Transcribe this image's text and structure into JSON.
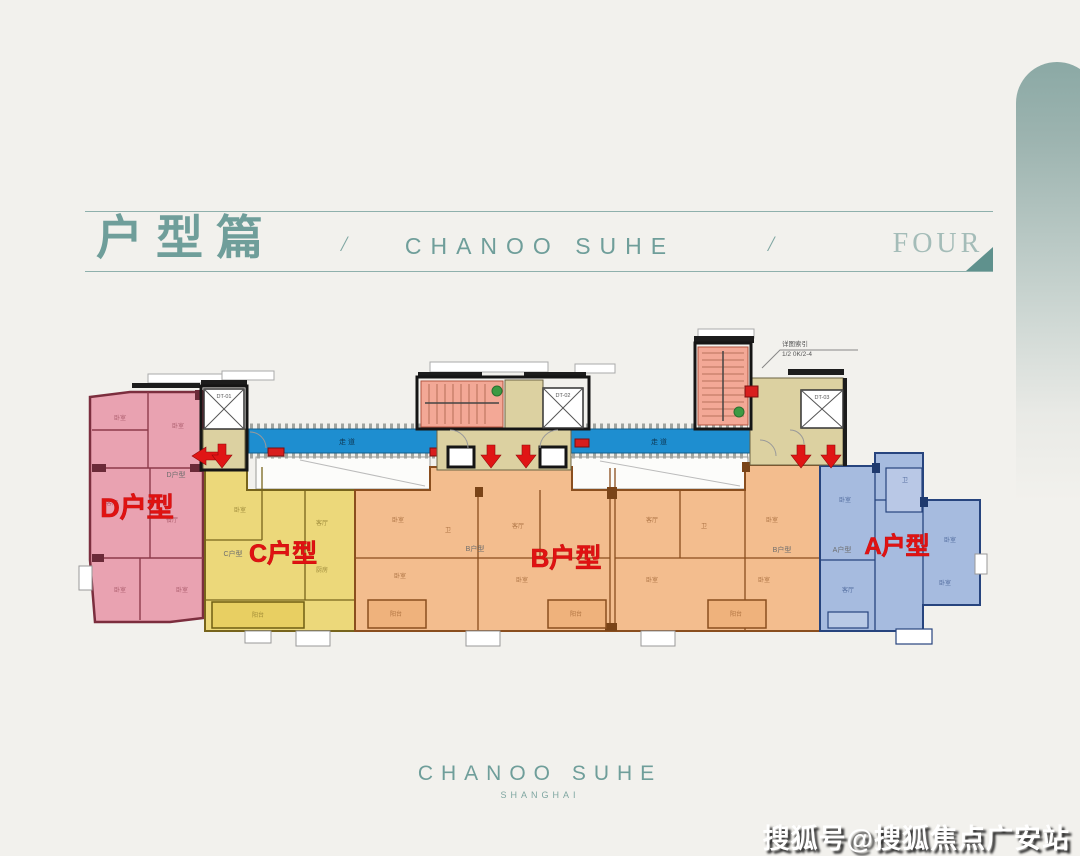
{
  "header": {
    "title": "户型篇",
    "sep1": "/",
    "brand": "CHANOO SUHE",
    "sep2": "/",
    "chapter": "FOUR"
  },
  "colors": {
    "teal": "#6f9e9a",
    "teal_light": "#a4bcb8",
    "background": "#f2f1ed",
    "unit_d_fill": "#e9a2b1",
    "unit_d_wall": "#7c2e3e",
    "unit_c_fill": "#ecd87a",
    "unit_c_wall": "#77641c",
    "unit_b_fill": "#f3bd8e",
    "unit_b_wall": "#8a4e1e",
    "unit_a_fill": "#a6bbdf",
    "unit_a_wall": "#27447e",
    "corridor": "#1e8ed0",
    "stair": "#f3a896",
    "lobby": "#dcd1a1",
    "label_red": "#e01212",
    "arrow_red": "#e01515",
    "dot_green": "#3d9a43"
  },
  "floorplan": {
    "units": [
      {
        "id": "D",
        "label": "D户型",
        "small_label": "D户型"
      },
      {
        "id": "C",
        "label": "C户型",
        "small_label": "C户型"
      },
      {
        "id": "B",
        "label": "B户型",
        "small_label": "B户型"
      },
      {
        "id": "A",
        "label": "A户型",
        "small_label": "A户型"
      }
    ],
    "corridor_label": "走道",
    "elevators": [
      "DT-01",
      "DT-02",
      "DT-03"
    ],
    "annotation": {
      "line1": "详图索引",
      "line2": "1/2 0K/2-4"
    },
    "room_marks": [
      {
        "t": "卧室",
        "x": 120,
        "y": 420,
        "c": "#8d3b4b"
      },
      {
        "t": "卧室",
        "x": 178,
        "y": 428,
        "c": "#8d3b4b"
      },
      {
        "t": "客厅",
        "x": 112,
        "y": 505,
        "c": "#8d3b4b"
      },
      {
        "t": "餐厅",
        "x": 172,
        "y": 522,
        "c": "#8d3b4b"
      },
      {
        "t": "卧室",
        "x": 120,
        "y": 592,
        "c": "#8d3b4b"
      },
      {
        "t": "卧室",
        "x": 182,
        "y": 592,
        "c": "#8d3b4b"
      },
      {
        "t": "卧室",
        "x": 240,
        "y": 512,
        "c": "#77641c"
      },
      {
        "t": "客厅",
        "x": 322,
        "y": 525,
        "c": "#77641c"
      },
      {
        "t": "厨房",
        "x": 322,
        "y": 572,
        "c": "#77641c"
      },
      {
        "t": "阳台",
        "x": 258,
        "y": 617,
        "c": "#77641c"
      },
      {
        "t": "卧室",
        "x": 398,
        "y": 522,
        "c": "#8a4e1e"
      },
      {
        "t": "卫",
        "x": 448,
        "y": 532,
        "c": "#8a4e1e"
      },
      {
        "t": "客厅",
        "x": 518,
        "y": 528,
        "c": "#8a4e1e"
      },
      {
        "t": "卧室",
        "x": 400,
        "y": 578,
        "c": "#8a4e1e"
      },
      {
        "t": "卧室",
        "x": 522,
        "y": 582,
        "c": "#8a4e1e"
      },
      {
        "t": "客厅",
        "x": 652,
        "y": 522,
        "c": "#8a4e1e"
      },
      {
        "t": "卫",
        "x": 704,
        "y": 528,
        "c": "#8a4e1e"
      },
      {
        "t": "卧室",
        "x": 772,
        "y": 522,
        "c": "#8a4e1e"
      },
      {
        "t": "卧室",
        "x": 652,
        "y": 582,
        "c": "#8a4e1e"
      },
      {
        "t": "卧室",
        "x": 764,
        "y": 582,
        "c": "#8a4e1e"
      },
      {
        "t": "阳台",
        "x": 396,
        "y": 616,
        "c": "#8a4e1e"
      },
      {
        "t": "阳台",
        "x": 576,
        "y": 616,
        "c": "#8a4e1e"
      },
      {
        "t": "阳台",
        "x": 736,
        "y": 616,
        "c": "#8a4e1e"
      },
      {
        "t": "卧室",
        "x": 845,
        "y": 502,
        "c": "#27447e"
      },
      {
        "t": "卫",
        "x": 905,
        "y": 482,
        "c": "#27447e"
      },
      {
        "t": "卧室",
        "x": 950,
        "y": 542,
        "c": "#27447e"
      },
      {
        "t": "客厅",
        "x": 848,
        "y": 592,
        "c": "#27447e"
      },
      {
        "t": "卧室",
        "x": 945,
        "y": 585,
        "c": "#27447e"
      }
    ]
  },
  "footer": {
    "brand": "CHANOO SUHE",
    "sub": "SHANGHAI"
  },
  "watermark": "搜狐号@搜狐焦点广安站"
}
